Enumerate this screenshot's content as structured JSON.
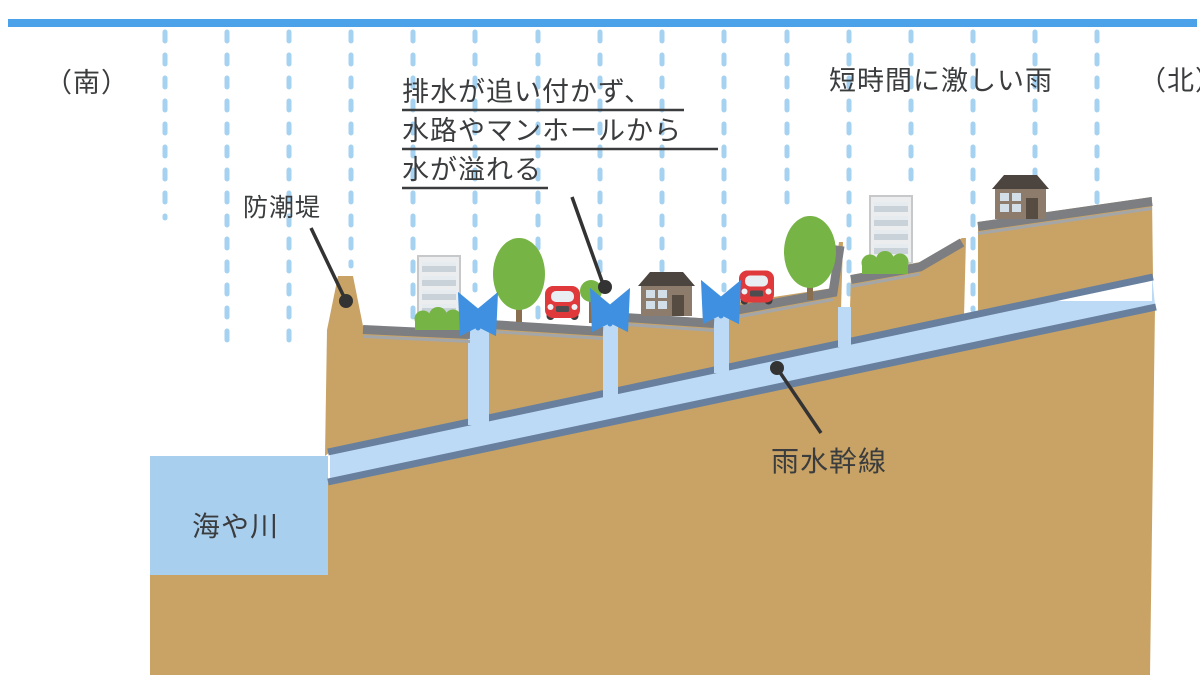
{
  "labels": {
    "south": "（南）",
    "north": "（北）",
    "heavy_rain": "短時間に激しい雨",
    "seawall": "防潮堤",
    "overflow": {
      "line1": "排水が追い付かず、",
      "line2": "水路やマンホールから",
      "line3": "水が溢れる"
    },
    "sea_river": "海や川",
    "storm_drain": "雨水幹線"
  },
  "colors": {
    "sky_bar": "#4ba2e8",
    "rain": "#a6d2f2",
    "ground": "#c9a365",
    "pavement": "#7c7e81",
    "sea": "#a9cfee",
    "water": "#bcdaf6",
    "pipe_border": "#68809e",
    "text": "#3a3c3e",
    "spray_arrow": "#3f90e0",
    "tree_green": "#76b445",
    "trunk_brown": "#8a6e50",
    "car_red": "#e0393b",
    "house_body": "#8d7c6b",
    "house_roof": "#4b443f",
    "building_wall": "#ebedee",
    "bush_green": "#76b445"
  }
}
